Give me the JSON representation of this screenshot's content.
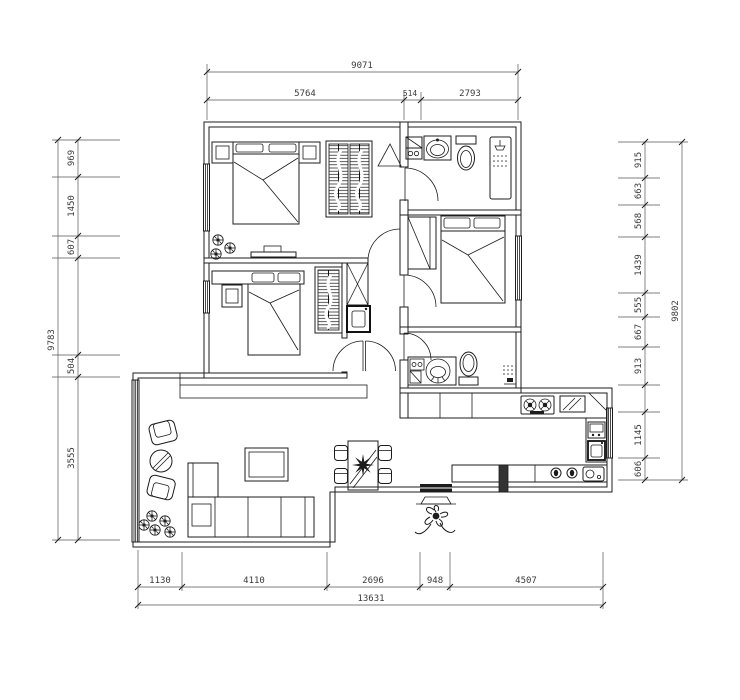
{
  "meta": {
    "title": "apartment-floor-plan",
    "canvas": {
      "width": 740,
      "height": 700
    },
    "colors": {
      "background": "#ffffff",
      "line": "#1c1c1c",
      "dim_text": "#3a3a3a"
    }
  },
  "dimensions": {
    "top": {
      "total": "9071",
      "segments": [
        "5764",
        "514",
        "2793"
      ]
    },
    "bottom": {
      "total": "13631",
      "segments": [
        "1130",
        "4110",
        "2696",
        "948",
        "4507"
      ]
    },
    "left": {
      "total": "9783",
      "segments": [
        "969",
        "1450",
        "607",
        "504",
        "3555"
      ]
    },
    "right": {
      "total": "9802",
      "segments": [
        "915",
        "663",
        "568",
        "1439",
        "555",
        "667",
        "913",
        "1145",
        "606"
      ]
    }
  },
  "icons": [
    "double-bed",
    "wardrobe-hanging",
    "nightstand",
    "tv-cabinet",
    "plant",
    "washing-machine",
    "washbasin",
    "toilet",
    "shower",
    "vanity-basin",
    "duct-shaft",
    "water-heater",
    "armchair",
    "round-side-table",
    "corner-sofa",
    "side-table",
    "coffee-table",
    "dining-table",
    "dining-chair",
    "table-centerpiece",
    "gas-stove",
    "cutting-board",
    "corner-shelf",
    "kitchen-counter",
    "kitchen-sink",
    "storage-jar",
    "entry-door",
    "entry-step",
    "entry-plant",
    "window",
    "door-swing"
  ]
}
